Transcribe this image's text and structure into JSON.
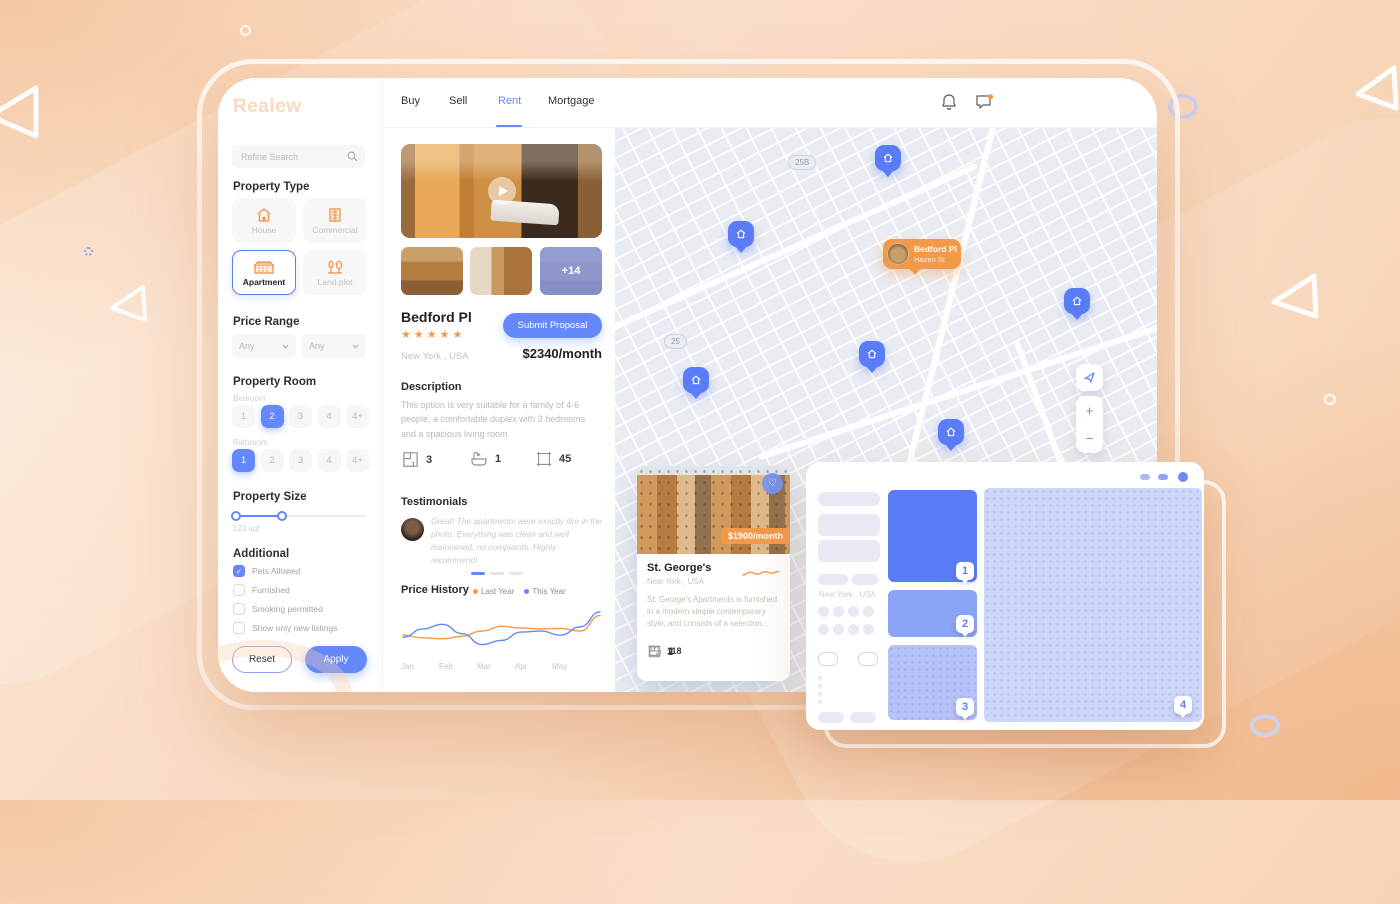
{
  "app": {
    "logo_text": "Realew"
  },
  "sidebar": {
    "search": {
      "placeholder": "Refine Search"
    },
    "property_type": {
      "title": "Property Type",
      "options": [
        {
          "label": "House",
          "selected": false
        },
        {
          "label": "Commercial",
          "selected": false
        },
        {
          "label": "Apartment",
          "selected": true
        },
        {
          "label": "Land plot",
          "selected": false
        }
      ]
    },
    "price_range": {
      "title": "Price Range",
      "min_value": "Any",
      "max_value": "Any"
    },
    "property_room": {
      "title": "Property Room",
      "bedroom": {
        "label": "Bedroom",
        "options": [
          "1",
          "2",
          "3",
          "4",
          "4+"
        ],
        "selected": "2"
      },
      "bathroom": {
        "label": "Bathroom",
        "options": [
          "1",
          "2",
          "3",
          "4",
          "4+"
        ],
        "selected": "1"
      }
    },
    "property_size": {
      "title": "Property Size",
      "value": "123 sqf"
    },
    "additional": {
      "title": "Additional",
      "options": [
        {
          "label": "Pets Allowed",
          "checked": true
        },
        {
          "label": "Furnished",
          "checked": false
        },
        {
          "label": "Smoking permitted",
          "checked": false
        },
        {
          "label": "Show only new listings",
          "checked": false
        }
      ]
    },
    "reset_label": "Reset",
    "apply_label": "Apply"
  },
  "header": {
    "tabs": [
      {
        "label": "Buy",
        "active": false
      },
      {
        "label": "Sell",
        "active": false
      },
      {
        "label": "Rent",
        "active": true
      },
      {
        "label": "Mortgage",
        "active": false
      }
    ],
    "user_name": "Amanda Grey"
  },
  "listing": {
    "gallery_more": "+14",
    "title": "Bedford Pl",
    "rating_stars": "★★★★★",
    "location": "New York , USA",
    "cta_label": "Submit Proposal",
    "price": "$2340/month",
    "description_title": "Description",
    "description": "This option is very suitable for a family of 4-6 people, a comfortable duplex with 3 bedrooms and a spacious living room",
    "amenities": {
      "rooms": "3",
      "baths": "1",
      "area": "45"
    },
    "testimonials_title": "Testimonials",
    "testimonial_text": "Great! The apartments were exactly like in the photo. Everything was clean and well maintained, no complaints. Highly recommend!",
    "price_history_title": "Price History"
  },
  "chart_data": [
    {
      "type": "line",
      "title": "Price History",
      "categories": [
        "Jan",
        "Feb",
        "Mar",
        "Apr",
        "May"
      ],
      "series": [
        {
          "name": "Last Year",
          "color": "#F2994A",
          "values": [
            40,
            35,
            33,
            38,
            48,
            57,
            54,
            52,
            53,
            48,
            78
          ]
        },
        {
          "name": "This Year",
          "color": "#6488FA",
          "values": [
            36,
            52,
            61,
            43,
            22,
            30,
            46,
            48,
            40,
            56,
            85
          ]
        }
      ],
      "ylim": [
        0,
        100
      ],
      "grid": false,
      "legend_position": "top-right"
    },
    {
      "type": "line",
      "title": "price trend sparkline",
      "categories": [],
      "series": [
        {
          "name": "trend",
          "color": "#F2994A",
          "values": [
            30,
            58,
            38,
            62,
            48,
            66
          ]
        }
      ],
      "ylim": [
        0,
        100
      ],
      "grid": false
    }
  ],
  "map": {
    "road_badges": [
      "25B",
      "25"
    ],
    "active_pin": {
      "title": "Bedford Pl",
      "subtitle": "Hazen St"
    },
    "controls": {
      "zoom_in": "+",
      "zoom_out": "−"
    }
  },
  "map_card": {
    "price_badge": "$1900/month",
    "title": "St. George's",
    "location": "New York , USA",
    "description": "St. George's Apartments is furnished in a modern simple contemporary style, and consists of a selection...",
    "amenities": {
      "rooms": "2",
      "baths": "1",
      "area": "118"
    }
  },
  "overlay_window": {
    "tags": [
      "1",
      "2",
      "3",
      "4"
    ],
    "skeleton_location": "New York , USA"
  }
}
